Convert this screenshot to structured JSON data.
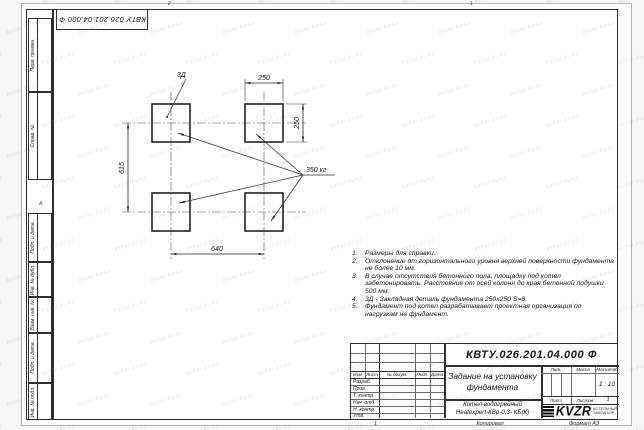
{
  "watermark": {
    "text": "kvzar.kv.kz"
  },
  "sheet": {
    "stamp_doc_number": "КВТУ 026.201.04.000 Ф",
    "margin_marks": {
      "top_left": "2",
      "top_right": "1",
      "left_zone": "А",
      "footer_sheet": "1"
    },
    "left_fields": [
      "Перв. примен.",
      "Справ. №",
      "Подп. и дата",
      "Инв. № дубл.",
      "Взам. инв. №",
      "Подп. и дата",
      "Инв. № подл."
    ]
  },
  "drawing": {
    "dim_width": "250",
    "dim_height": "250",
    "dim_vertical_spacing": "615",
    "dim_horizontal_spacing": "640",
    "label_embedded_part": "3Д",
    "label_load": "350 кг"
  },
  "notes": [
    {
      "num": "1.",
      "text": "Размеры для справки."
    },
    {
      "num": "2.",
      "text": "Отклонение от горизонтального уровня верхней поверхности фундамента не более 10 мм."
    },
    {
      "num": "3.",
      "text": "В случае отсутствия бетонного пола, площадку под котел забетонировать. Расстояние от осей колонн до края бетонной подушки 500 мм."
    },
    {
      "num": "4.",
      "text": "3Д - Закладная деталь фундамента 250х250 S=8."
    },
    {
      "num": "5.",
      "text": "Фундамент под котел разрабатывает проектная организация по нагрузкам на фундамент."
    }
  ],
  "title_block": {
    "doc_number": "КВТУ.026.201.04.000 Ф",
    "title": {
      "line1": "Задание на установку",
      "line2": "фундамента"
    },
    "product": {
      "line1": "Котел водогрейный",
      "line2": "Heatexpert-КВр-0,3- КБ(К)"
    },
    "headers": {
      "izm": "Изм.",
      "list": "Лист",
      "docnum": "№ докум.",
      "podp": "Подп.",
      "data": "Дата",
      "lit": "Лит.",
      "massa": "Масса",
      "masshtab": "Масштаб",
      "list2": "Лист",
      "listov": "Листов"
    },
    "signature_rows": [
      "Разраб.",
      "Пров.",
      "Т. контр.",
      "Нач. отд.",
      "Н. контр.",
      "Утв."
    ],
    "scale": "1 : 10",
    "sheets_total": "1",
    "logo": {
      "name": "KVZR",
      "tagline1": "КОТЕЛЬНЫЙ",
      "tagline2": "ЗАВОД КЗР"
    }
  },
  "footer": {
    "copied": "Копировал",
    "format": "Формат А3"
  }
}
